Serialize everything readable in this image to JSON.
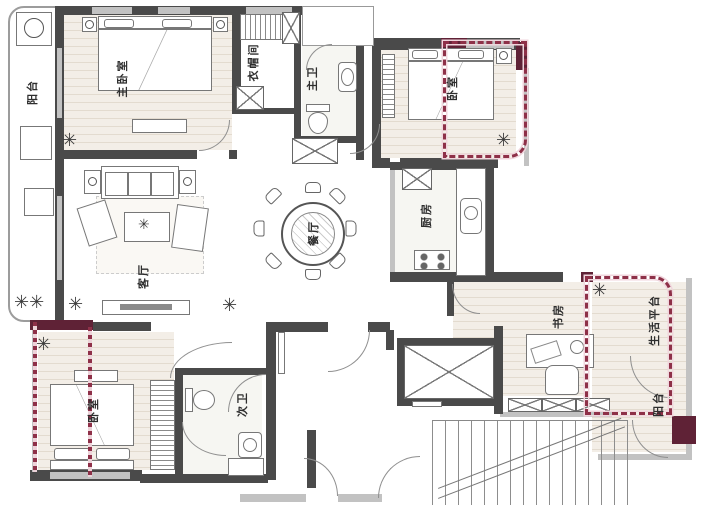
{
  "plan": {
    "rooms": [
      {
        "id": "master-bedroom",
        "label": "主卧室"
      },
      {
        "id": "walk-in-closet",
        "label": "衣帽间"
      },
      {
        "id": "master-bath",
        "label": "主卫"
      },
      {
        "id": "bedroom-top-right",
        "label": "卧室"
      },
      {
        "id": "balcony-left",
        "label": "阳台"
      },
      {
        "id": "living-room",
        "label": "客厅"
      },
      {
        "id": "dining-room",
        "label": "餐厅"
      },
      {
        "id": "kitchen",
        "label": "厨房"
      },
      {
        "id": "study",
        "label": "书房"
      },
      {
        "id": "utility-platform",
        "label": "生活平台"
      },
      {
        "id": "balcony-bottom-right",
        "label": "阳台"
      },
      {
        "id": "bedroom-bottom-left",
        "label": "卧室"
      },
      {
        "id": "second-bath",
        "label": "次卫"
      }
    ],
    "colors": {
      "wall": "#4a4a4a",
      "window": "#c2c2c2",
      "overlay_dot": "#8e3048",
      "overlay_band": "#f0d6dd",
      "overlay_block": "#5f2236",
      "floor_line": "#e3dbcf"
    }
  }
}
